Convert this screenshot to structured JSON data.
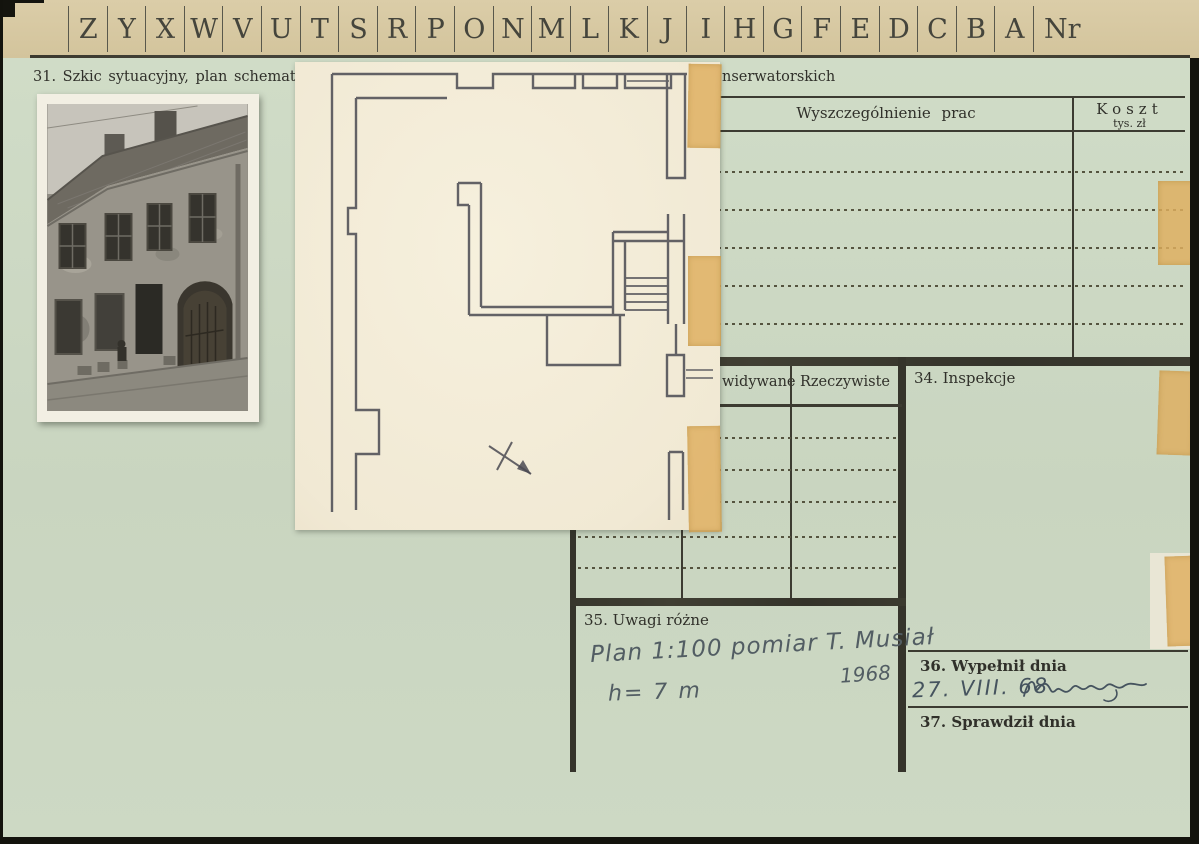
{
  "tab_strip": {
    "letters": [
      "Z",
      "Y",
      "X",
      "W",
      "V",
      "U",
      "T",
      "S",
      "R",
      "P",
      "O",
      "N",
      "M",
      "L",
      "K",
      "J",
      "I",
      "H",
      "G",
      "F",
      "E",
      "D",
      "C",
      "B",
      "A"
    ],
    "nr_label": "Nr"
  },
  "headings": {
    "section31_label": "31. Szkic sytuacyjny, plan schematyczn",
    "section32_visible_fragment": "nserwatorskich"
  },
  "works_table": {
    "header_works": "Wyszczególnienie prac",
    "header_cost": "Koszt",
    "header_cost_unit": "tys. zł"
  },
  "progress_table": {
    "header_expected_visible_fragment": "widywane",
    "header_actual": "Rzeczywiste"
  },
  "sections": {
    "inspections_label": "34. Inspekcje",
    "remarks_label": "35. Uwagi różne",
    "filled_label": "36. Wypełnił dnia",
    "checked_label": "37. Sprawdził dnia"
  },
  "handwriting": {
    "remark_line1": "Plan 1:100 pomiar T. Musiał",
    "remark_year": "1968",
    "remark_line2": "h= 7 m",
    "filled_date": "27. VIII. 68"
  },
  "colors": {
    "card_green": "#cbd7c2",
    "strip_tan": "#d7c8a2",
    "plan_paper": "#f3ecd8",
    "tape": "#deaf5f",
    "print_ink": "#30302a",
    "pencil": "#525d63"
  }
}
